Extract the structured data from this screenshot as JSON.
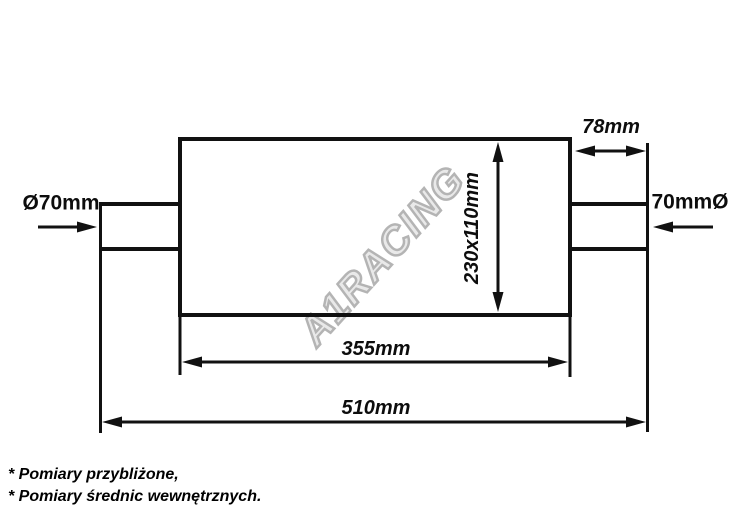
{
  "watermark": {
    "text": "A1RACING"
  },
  "dimensions": {
    "inlet_left": {
      "label": "Ø70mm",
      "value_mm": 70
    },
    "outlet_right": {
      "label": "70mmØ",
      "value_mm": 70
    },
    "outlet_stub": {
      "label": "78mm",
      "value_mm": 78
    },
    "body_section": {
      "label": "230x110mm"
    },
    "body_length": {
      "label": "355mm",
      "value_mm": 355
    },
    "total_length": {
      "label": "510mm",
      "value_mm": 510
    }
  },
  "footnotes": {
    "line1": "* Pomiary przybliżone,",
    "line2": "* Pomiary średnic wewnętrznych."
  },
  "colors": {
    "line": "#111111",
    "background": "#ffffff",
    "watermark_outline": "#a8a8a8"
  }
}
